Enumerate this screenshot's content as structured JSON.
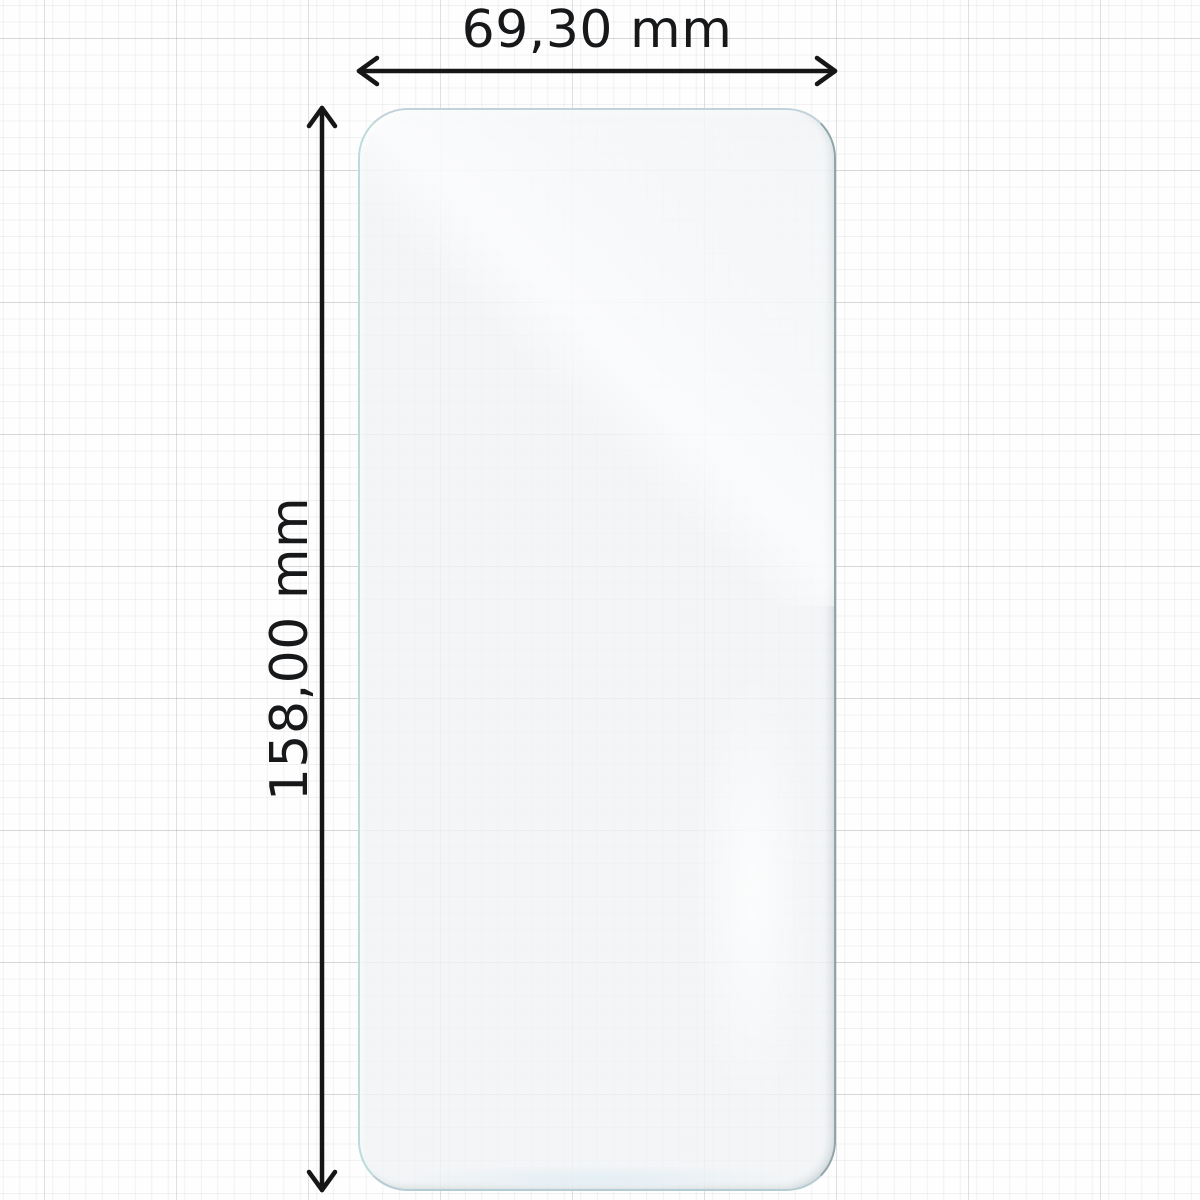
{
  "diagram": {
    "kind": "product-dimension-drawing",
    "object": "transparent screen protector film on graph paper",
    "width_label": "69,30 mm",
    "height_label": "158,00 mm"
  },
  "icons": {
    "width_arrow": "double-headed horizontal dimension arrow",
    "height_arrow": "double-headed vertical dimension arrow"
  },
  "colors": {
    "background": "#fefefe",
    "grid_minor": "#ededf0",
    "grid_major": "#d6d6d9",
    "arrow_stroke": "#161616",
    "label_text": "#17181a",
    "film_fill": "#f1f3f5",
    "film_edge_light_teal": "#bddbdb",
    "film_edge_dark": "#8fa5a8"
  }
}
